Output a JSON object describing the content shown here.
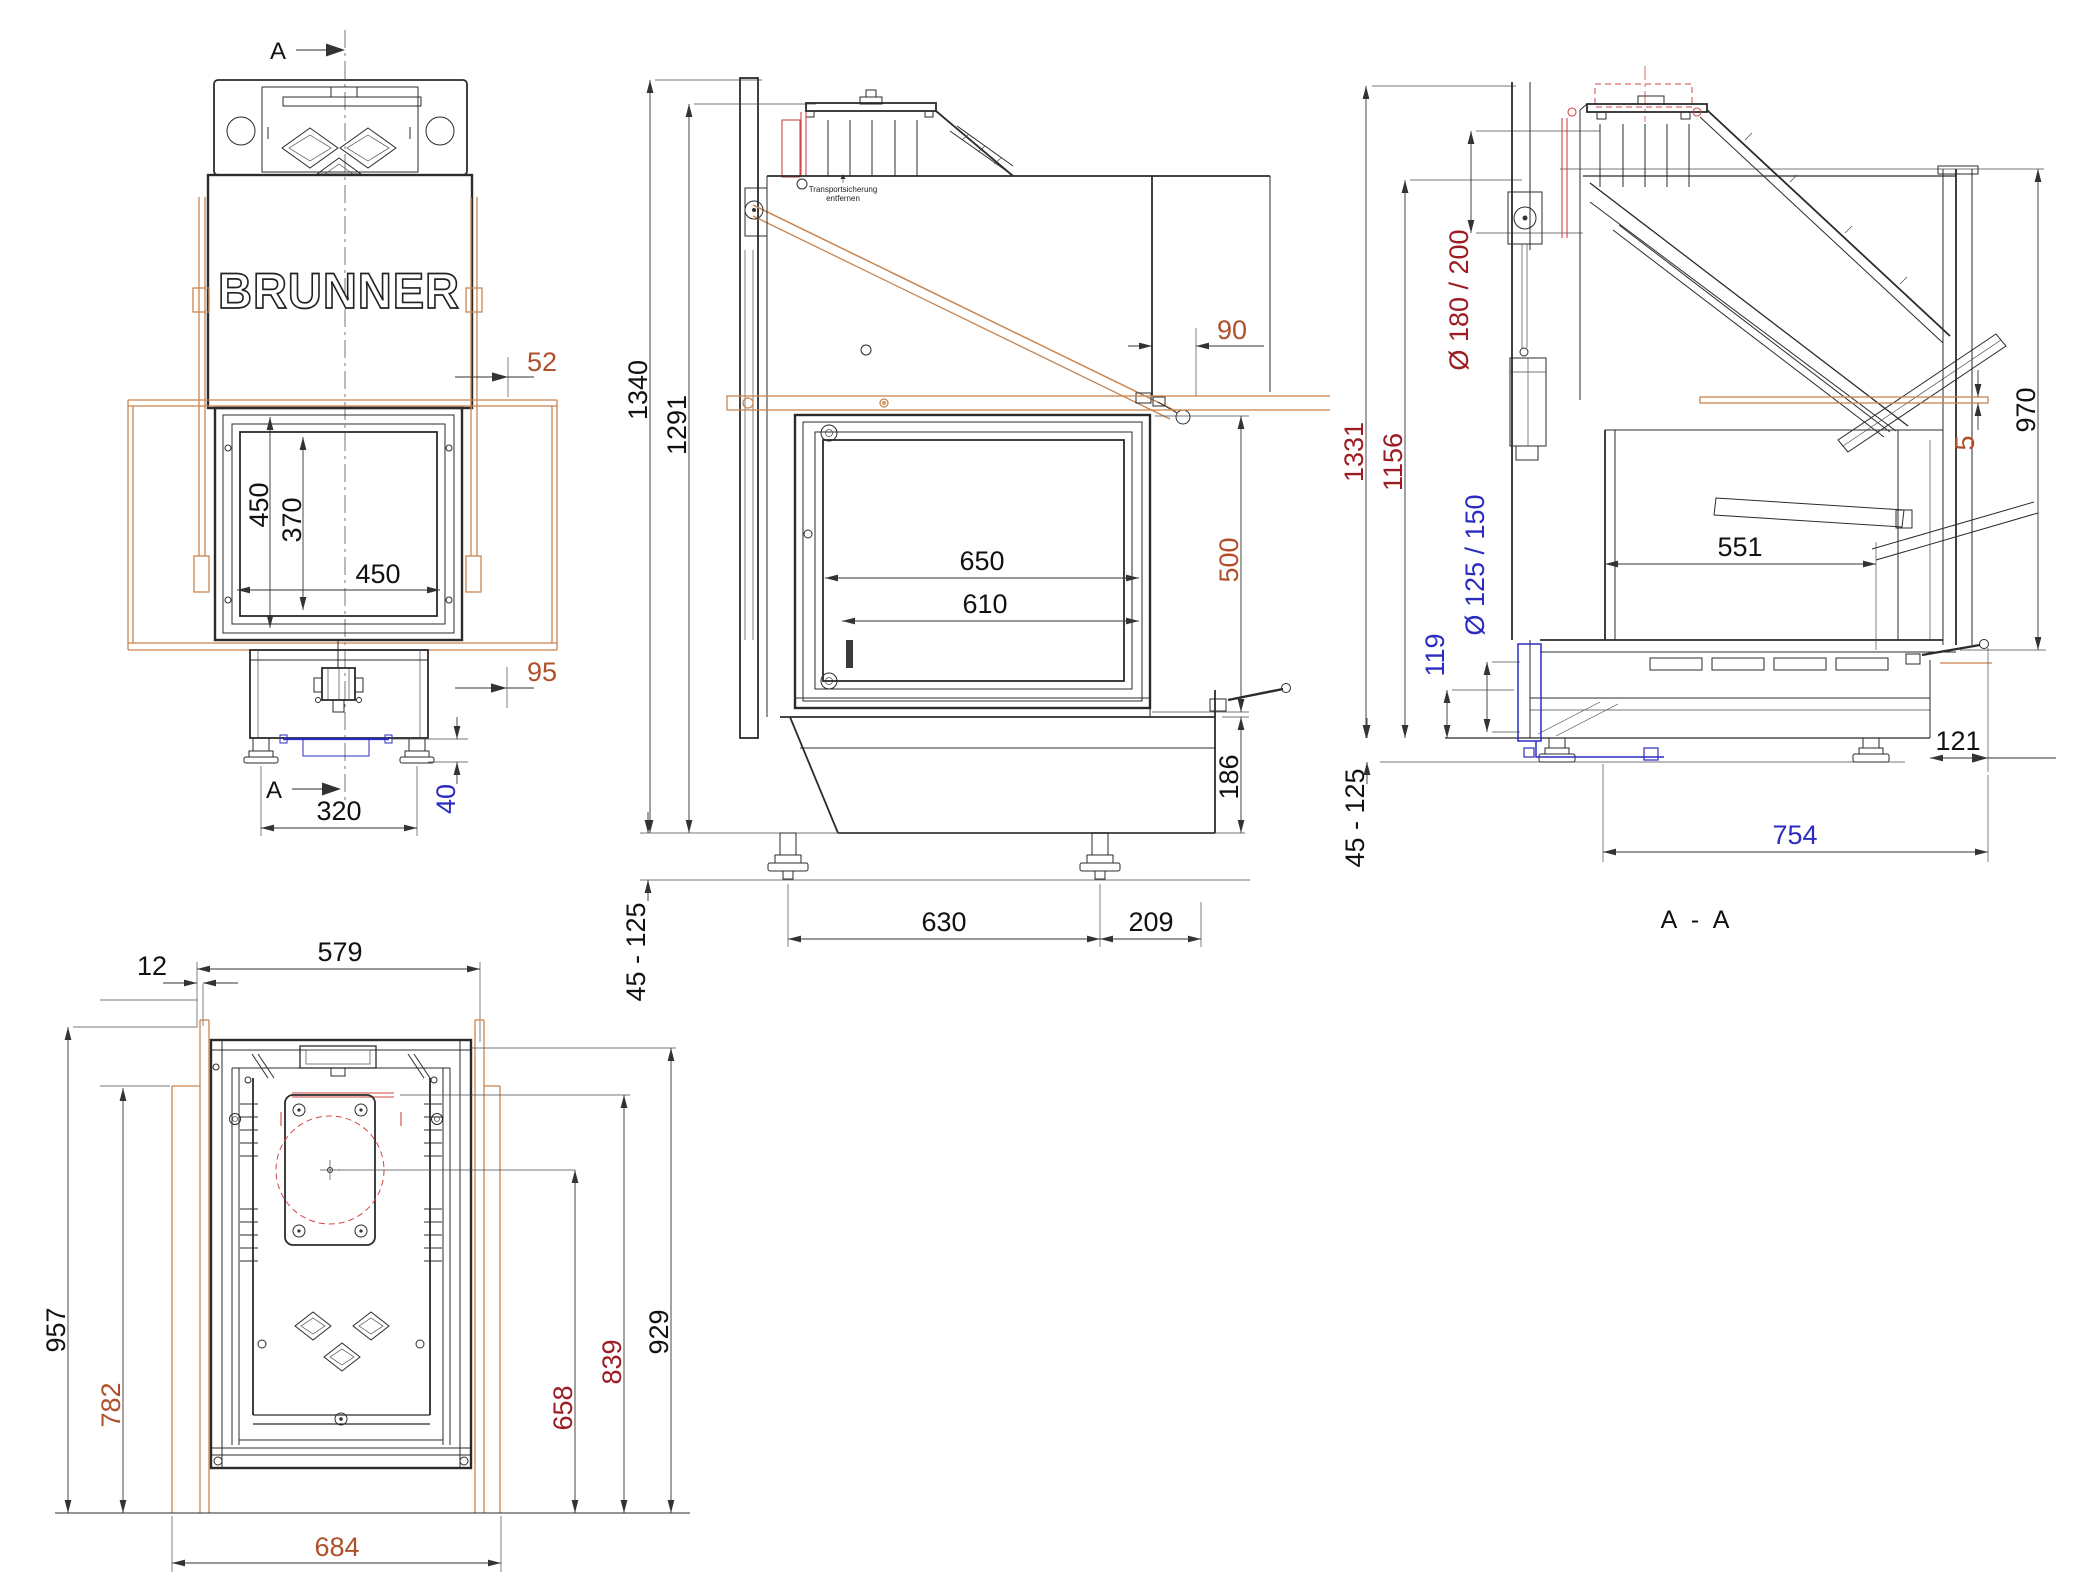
{
  "meta": {
    "document_type": "technical drawing",
    "sheet_background": "#ffffff"
  },
  "colors": {
    "line": "#2b2b2b",
    "text": "#111111",
    "brown_dim": "#b0502a",
    "tan_frame": "#c9854f",
    "blue_dim": "#2b2bc4",
    "dark_red_dim": "#9b1c22",
    "red_marking": "#d34545"
  },
  "labels": {
    "brand_logo": "BRUNNER",
    "section_marker": "A",
    "section_title": "A - A",
    "note_line1": "Transportsicherung",
    "note_line2": "entfernen"
  },
  "front_view": {
    "dims": {
      "offset_top": "52",
      "glass_height": "450",
      "inner_height": "370",
      "glass_width": "450",
      "offset_bottom": "95",
      "base_height": "40",
      "feet_spacing": "320"
    }
  },
  "side_view": {
    "dims": {
      "total_height": "1340",
      "frame_height": "1291",
      "wall_clearance": "90",
      "glass_width_outer": "650",
      "glass_width_inner": "610",
      "glass_height": "500",
      "base_height": "186",
      "feet_range": "45 - 125",
      "feet_spacing": "630",
      "feet_to_back": "209"
    }
  },
  "section_view": {
    "dims": {
      "total_height": "1331",
      "hood_height": "1156",
      "flue_diameter": "Ø 180 / 200",
      "front_glass_height": "970",
      "plate_thickness": "5",
      "glass_depth": "551",
      "air_inlet_diameter": "Ø 125 / 150",
      "air_inlet_height": "119",
      "base_offset": "121",
      "depth": "754",
      "feet_range": "45 - 125"
    }
  },
  "plan_view": {
    "dims": {
      "body_width": "579",
      "wall_gap": "12",
      "total_depth": "957",
      "frame_depth": "782",
      "flue_axis_depth": "658",
      "rail_depth": "839",
      "body_depth": "929",
      "frame_width": "684"
    }
  }
}
